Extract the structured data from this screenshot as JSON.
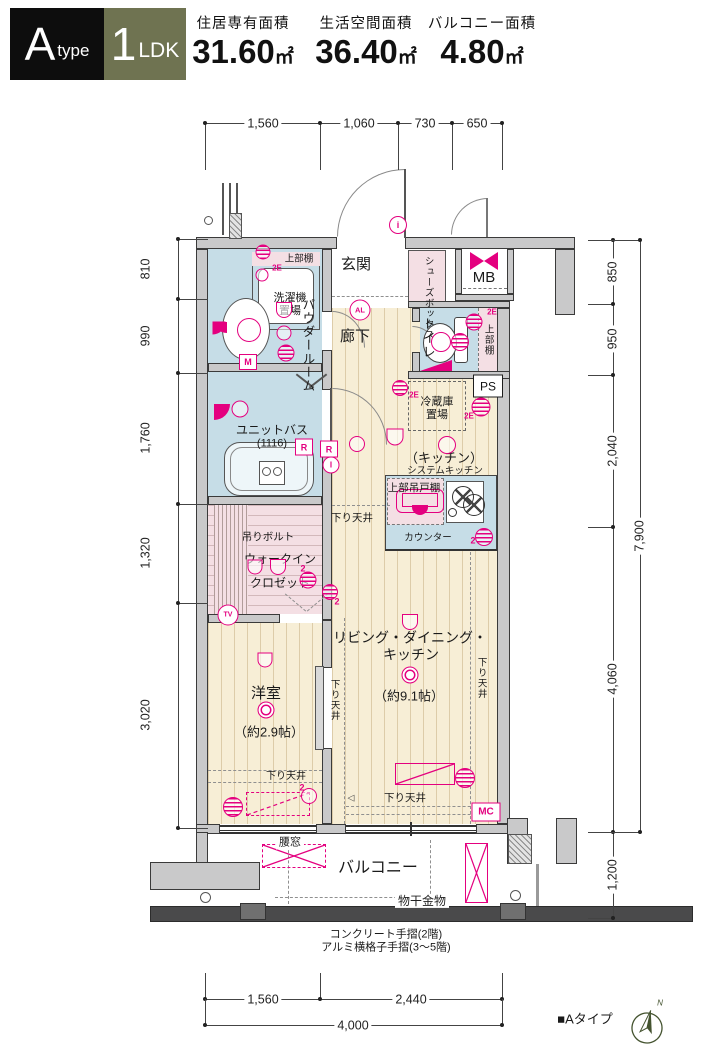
{
  "header": {
    "type_main": "A",
    "type_sub": "type",
    "plan_main": "1",
    "plan_sub": "LDK",
    "areas": [
      {
        "label": "住居専有面積",
        "value": "31.60",
        "unit": "㎡"
      },
      {
        "label": "生活空間面積",
        "value": "36.40",
        "unit": "㎡"
      },
      {
        "label": "バルコニー面積",
        "value": "4.80",
        "unit": "㎡"
      }
    ]
  },
  "colors": {
    "magenta": "#e4007f",
    "olive": "#6f7351",
    "wall_gray": "#c9c9ca",
    "floor_beige": "#f7eed6",
    "wet_blue": "#c6dde7",
    "closet_pink": "#f4dfe4"
  },
  "dims": {
    "top": {
      "axis": "h",
      "line": [
        205,
        123,
        502
      ],
      "ticks": [
        205,
        320,
        398,
        452,
        502
      ],
      "tick_len": 47,
      "labels": [
        {
          "t": "1,560",
          "c": 263
        },
        {
          "t": "1,060",
          "c": 359
        },
        {
          "t": "730",
          "c": 425
        },
        {
          "t": "650",
          "c": 477
        }
      ]
    },
    "bottom_seg": {
      "axis": "h",
      "line": [
        205,
        999,
        502
      ],
      "ticks": [
        205,
        320,
        502
      ],
      "tick_len": -26,
      "labels": [
        {
          "t": "1,560",
          "c": 263
        },
        {
          "t": "2,440",
          "c": 411
        }
      ]
    },
    "bottom_total": {
      "axis": "h",
      "line": [
        205,
        1025,
        502
      ],
      "ticks": [
        205,
        502
      ],
      "tick_len": -26,
      "labels": [
        {
          "t": "4,000",
          "c": 353
        }
      ]
    },
    "left": {
      "axis": "v",
      "line": [
        178,
        239,
        828
      ],
      "ticks": [
        239,
        299,
        373,
        504,
        603,
        828
      ],
      "tick_len": 30,
      "label_x": 146,
      "labels": [
        {
          "t": "810",
          "c": 269
        },
        {
          "t": "990",
          "c": 336
        },
        {
          "t": "1,760",
          "c": 438
        },
        {
          "t": "1,320",
          "c": 553
        },
        {
          "t": "3,020",
          "c": 715
        }
      ]
    },
    "right_inner": {
      "axis": "v",
      "line": [
        613,
        240,
        918
      ],
      "ticks": [
        240,
        304,
        375,
        527,
        832,
        918
      ],
      "tick_len": -25,
      "label_x": 613,
      "labels": [
        {
          "t": "850",
          "c": 272
        },
        {
          "t": "950",
          "c": 339
        },
        {
          "t": "2,040",
          "c": 451
        },
        {
          "t": "4,060",
          "c": 679
        },
        {
          "t": "1,200",
          "c": 875
        }
      ]
    },
    "right_outer": {
      "axis": "v",
      "line": [
        640,
        240,
        832
      ],
      "ticks": [
        240,
        832
      ],
      "tick_len": -52,
      "label_x": 640,
      "labels": [
        {
          "t": "7,900",
          "c": 536
        }
      ]
    }
  },
  "texts": [
    {
      "n": "room-label-genkan",
      "t": "玄関",
      "x": 356,
      "y": 265,
      "fs": 15
    },
    {
      "n": "label-shoes-box",
      "t": "シューズボックス",
      "x": 428,
      "y": 281,
      "fs": 9.5,
      "v": 1,
      "h": 50
    },
    {
      "n": "label-mb",
      "t": "MB",
      "x": 484,
      "y": 278,
      "fs": 15
    },
    {
      "n": "label-upper-shelf-laundry",
      "t": "上部棚",
      "x": 299,
      "y": 259,
      "fs": 9.5
    },
    {
      "n": "label-laundry-2e",
      "t": "2E",
      "x": 277,
      "y": 268,
      "fs": 8,
      "c": "m",
      "b": 1
    },
    {
      "n": "label-laundry",
      "t": "洗濯機置場",
      "x": 290,
      "y": 305,
      "fs": 11,
      "w": 40
    },
    {
      "n": "room-label-powder",
      "t": "パウダールーム",
      "x": 307,
      "y": 330,
      "fs": 12.5,
      "v": 1,
      "h": 64
    },
    {
      "n": "room-label-rouka",
      "t": "廊下",
      "x": 355,
      "y": 337,
      "fs": 15
    },
    {
      "n": "room-label-toilet",
      "t": "トイレ",
      "x": 428,
      "y": 338,
      "fs": 13,
      "v": 1,
      "h": 46
    },
    {
      "n": "label-upper-shelf-toilet",
      "t": "上部棚",
      "x": 488,
      "y": 340,
      "fs": 9.5,
      "v": 1,
      "h": 34
    },
    {
      "n": "label-toilet-2e",
      "t": "2E",
      "x": 492,
      "y": 312,
      "fs": 8,
      "c": "m",
      "b": 1
    },
    {
      "n": "label-fridge",
      "t": "冷蔵庫置場",
      "x": 437,
      "y": 409,
      "fs": 11,
      "w": 42
    },
    {
      "n": "label-fridge-2e",
      "t": "2E",
      "x": 414,
      "y": 395,
      "fs": 8,
      "c": "m",
      "b": 1
    },
    {
      "n": "label-wall-2e",
      "t": "2E",
      "x": 469,
      "y": 416,
      "fs": 8,
      "c": "m",
      "b": 1
    },
    {
      "n": "room-label-kitchen",
      "t": "（キッチン）",
      "x": 444,
      "y": 458,
      "fs": 13
    },
    {
      "n": "label-system-kitchen",
      "t": "システムキッチン",
      "x": 445,
      "y": 471,
      "fs": 9.5
    },
    {
      "n": "label-hanging-cupboard",
      "t": "上部吊戸棚",
      "x": 414,
      "y": 488,
      "fs": 10.5
    },
    {
      "n": "label-counter",
      "t": "カウンター",
      "x": 428,
      "y": 538,
      "fs": 9.5
    },
    {
      "n": "label-counter-2",
      "t": "2",
      "x": 473,
      "y": 541,
      "fs": 9,
      "c": "m",
      "b": 1
    },
    {
      "n": "label-sagari-kitchen",
      "t": "下り天井",
      "x": 352,
      "y": 518,
      "fs": 10.5
    },
    {
      "n": "label-tsuri-bolt",
      "t": "吊りボルト",
      "x": 268,
      "y": 537,
      "fs": 10.5
    },
    {
      "n": "room-label-wic-1",
      "t": "ウォークイン",
      "x": 280,
      "y": 559,
      "fs": 12
    },
    {
      "n": "room-label-wic-2",
      "t": "クロゼット",
      "x": 280,
      "y": 583,
      "fs": 12
    },
    {
      "n": "label-wic-2a",
      "t": "2",
      "x": 303,
      "y": 569,
      "fs": 9,
      "c": "m",
      "b": 1
    },
    {
      "n": "label-wic-2b",
      "t": "2",
      "x": 337,
      "y": 602,
      "fs": 9,
      "c": "m",
      "b": 1
    },
    {
      "n": "label-unit-bath",
      "t": "ユニットバス",
      "x": 272,
      "y": 430,
      "fs": 12
    },
    {
      "n": "label-unit-bath-size",
      "t": "(1116)",
      "x": 272,
      "y": 444,
      "fs": 11
    },
    {
      "n": "room-label-ldk-1",
      "t": "リビング・ダイニング・",
      "x": 410,
      "y": 638,
      "fs": 14
    },
    {
      "n": "room-label-ldk-2",
      "t": "キッチン",
      "x": 411,
      "y": 655,
      "fs": 14
    },
    {
      "n": "label-ldk-size",
      "t": "（約9.1帖）",
      "x": 409,
      "y": 696,
      "fs": 13
    },
    {
      "n": "label-sagari-ldk-left",
      "t": "下り天井",
      "x": 334,
      "y": 700,
      "fs": 9.5,
      "v": 1,
      "h": 44
    },
    {
      "n": "label-sagari-ldk-right",
      "t": "下り天井",
      "x": 481,
      "y": 678,
      "fs": 9.5,
      "v": 1,
      "h": 44
    },
    {
      "n": "room-label-yoshitsu",
      "t": "洋室",
      "x": 266,
      "y": 694,
      "fs": 15
    },
    {
      "n": "label-yoshitsu-size",
      "t": "（約2.9帖）",
      "x": 269,
      "y": 732,
      "fs": 13
    },
    {
      "n": "label-sagari-yoshitsu",
      "t": "下り天井",
      "x": 286,
      "y": 777,
      "fs": 10
    },
    {
      "n": "label-sagari-bottom",
      "t": "下り天井",
      "x": 405,
      "y": 798,
      "fs": 10.5
    },
    {
      "n": "label-yoshitsu-2",
      "t": "2",
      "x": 302,
      "y": 788,
      "fs": 9,
      "c": "m",
      "b": 1
    },
    {
      "n": "door-arrow-icon",
      "t": "◁",
      "x": 351,
      "y": 798,
      "fs": 9,
      "c": "#444"
    },
    {
      "n": "label-koshimado",
      "t": "腰窓",
      "x": 290,
      "y": 843,
      "fs": 11,
      "bg": 1
    },
    {
      "n": "room-label-balcony",
      "t": "バルコニー",
      "x": 378,
      "y": 869,
      "fs": 16
    },
    {
      "n": "label-monohoshi",
      "t": "物干金物",
      "x": 422,
      "y": 901,
      "fs": 12,
      "bg": 1
    },
    {
      "n": "note-handrail-1",
      "t": "コンクリート手摺(2階)",
      "x": 386,
      "y": 935,
      "fs": 11
    },
    {
      "n": "note-handrail-2",
      "t": "アルミ横格子手摺(3〜5階)",
      "x": 386,
      "y": 948,
      "fs": 11
    },
    {
      "n": "footer-type-label",
      "t": "■Aタイプ",
      "x": 585,
      "y": 1019,
      "fs": 13
    },
    {
      "n": "compass-n-label",
      "t": "N",
      "x": 660,
      "y": 1003,
      "fs": 8,
      "c": "#44532f",
      "i": 1
    }
  ],
  "tags": [
    {
      "n": "tag-i",
      "k": "circ",
      "t": "i",
      "x": 398,
      "y": 225,
      "w": 16,
      "h": 16,
      "fs": 9
    },
    {
      "n": "tag-al",
      "k": "circ",
      "t": "AL",
      "x": 360,
      "y": 310,
      "w": 19,
      "h": 19,
      "fs": 7.5
    },
    {
      "n": "tag-m",
      "k": "box",
      "t": "M",
      "x": 248,
      "y": 362,
      "w": 16,
      "h": 14,
      "fs": 9
    },
    {
      "n": "tag-r1",
      "k": "box",
      "t": "R",
      "x": 304,
      "y": 447,
      "w": 16,
      "h": 15,
      "fs": 9
    },
    {
      "n": "tag-r2",
      "k": "box",
      "t": "R",
      "x": 329,
      "y": 449,
      "w": 16,
      "h": 15,
      "fs": 9
    },
    {
      "n": "tag-i2",
      "k": "circ",
      "t": "I",
      "x": 331,
      "y": 465,
      "w": 15,
      "h": 15,
      "fs": 8
    },
    {
      "n": "tag-tv",
      "k": "circ",
      "t": "TV",
      "x": 228,
      "y": 615,
      "w": 19,
      "h": 19,
      "fs": 7
    },
    {
      "n": "tag-mc",
      "k": "box",
      "t": "MC",
      "x": 486,
      "y": 812,
      "w": 27,
      "h": 17,
      "fs": 10
    },
    {
      "n": "tag-ps",
      "k": "boxk",
      "t": "PS",
      "x": 488,
      "y": 386,
      "w": 28,
      "h": 21,
      "fs": 12
    }
  ],
  "symbols": [
    {
      "n": "vent-laundry-icon",
      "k": "stripe",
      "x": 263,
      "y": 252,
      "d": 15
    },
    {
      "n": "light-laundry-icon",
      "k": "circ",
      "x": 262,
      "y": 275,
      "d": 13
    },
    {
      "n": "light-powder-a-icon",
      "k": "half",
      "x": 284,
      "y": 310,
      "d": 16
    },
    {
      "n": "light-powder-b-icon",
      "k": "circ",
      "x": 284,
      "y": 333,
      "d": 15
    },
    {
      "n": "vent-powder-icon",
      "k": "stripe",
      "x": 286,
      "y": 353,
      "d": 17
    },
    {
      "n": "basin-faucet-icon",
      "k": "fan",
      "x": 219,
      "y": 328,
      "d": 13
    },
    {
      "n": "basin-light-icon",
      "k": "circ",
      "x": 249,
      "y": 330,
      "d": 24
    },
    {
      "n": "shower-head-icon",
      "k": "fan",
      "x": 222,
      "y": 412,
      "d": 16
    },
    {
      "n": "light-bath-icon",
      "k": "circ",
      "x": 240,
      "y": 409,
      "d": 17
    },
    {
      "n": "light-hall-icon",
      "k": "circ",
      "x": 357,
      "y": 444,
      "d": 16
    },
    {
      "n": "light-kitchen-a-icon",
      "k": "half",
      "x": 395,
      "y": 437,
      "d": 17
    },
    {
      "n": "light-kitchen-b-icon",
      "k": "circ",
      "x": 447,
      "y": 445,
      "d": 18
    },
    {
      "n": "vent-fridge-icon",
      "k": "stripe",
      "x": 400,
      "y": 388,
      "d": 16
    },
    {
      "n": "vent-wall-icon",
      "k": "stripe",
      "x": 481,
      "y": 407,
      "d": 19
    },
    {
      "n": "vent-counter-icon",
      "k": "stripe",
      "x": 484,
      "y": 537,
      "d": 18
    },
    {
      "n": "wic-hanger-a-icon",
      "k": "half",
      "x": 255,
      "y": 567,
      "d": 15
    },
    {
      "n": "wic-hanger-b-icon",
      "k": "half",
      "x": 278,
      "y": 567,
      "d": 16
    },
    {
      "n": "vent-wic-a-icon",
      "k": "stripe",
      "x": 308,
      "y": 580,
      "d": 17
    },
    {
      "n": "vent-wic-b-icon",
      "k": "stripe",
      "x": 330,
      "y": 592,
      "d": 16
    },
    {
      "n": "light-ldk-a-icon",
      "k": "half",
      "x": 410,
      "y": 622,
      "d": 16
    },
    {
      "n": "light-ldk-b-icon",
      "k": "dbl",
      "x": 410,
      "y": 675,
      "d": 17
    },
    {
      "n": "light-yoshitsu-a-icon",
      "k": "half",
      "x": 265,
      "y": 660,
      "d": 15
    },
    {
      "n": "light-yoshitsu-b-icon",
      "k": "dbl",
      "x": 266,
      "y": 710,
      "d": 17
    },
    {
      "n": "vent-yoshitsu-icon",
      "k": "stripe",
      "x": 233,
      "y": 807,
      "d": 20
    },
    {
      "n": "light-yoshitsu-c-icon",
      "k": "circ",
      "x": 309,
      "y": 796,
      "d": 16
    },
    {
      "n": "vent-ldk-icon",
      "k": "stripe",
      "x": 465,
      "y": 778,
      "d": 20
    },
    {
      "n": "toilet-sym-a-icon",
      "k": "circ",
      "x": 441,
      "y": 342,
      "d": 20
    },
    {
      "n": "toilet-sym-b-icon",
      "k": "stripe",
      "x": 460,
      "y": 342,
      "d": 18
    },
    {
      "n": "toilet-sym-c-icon",
      "k": "stripe",
      "x": 474,
      "y": 322,
      "d": 17
    }
  ]
}
